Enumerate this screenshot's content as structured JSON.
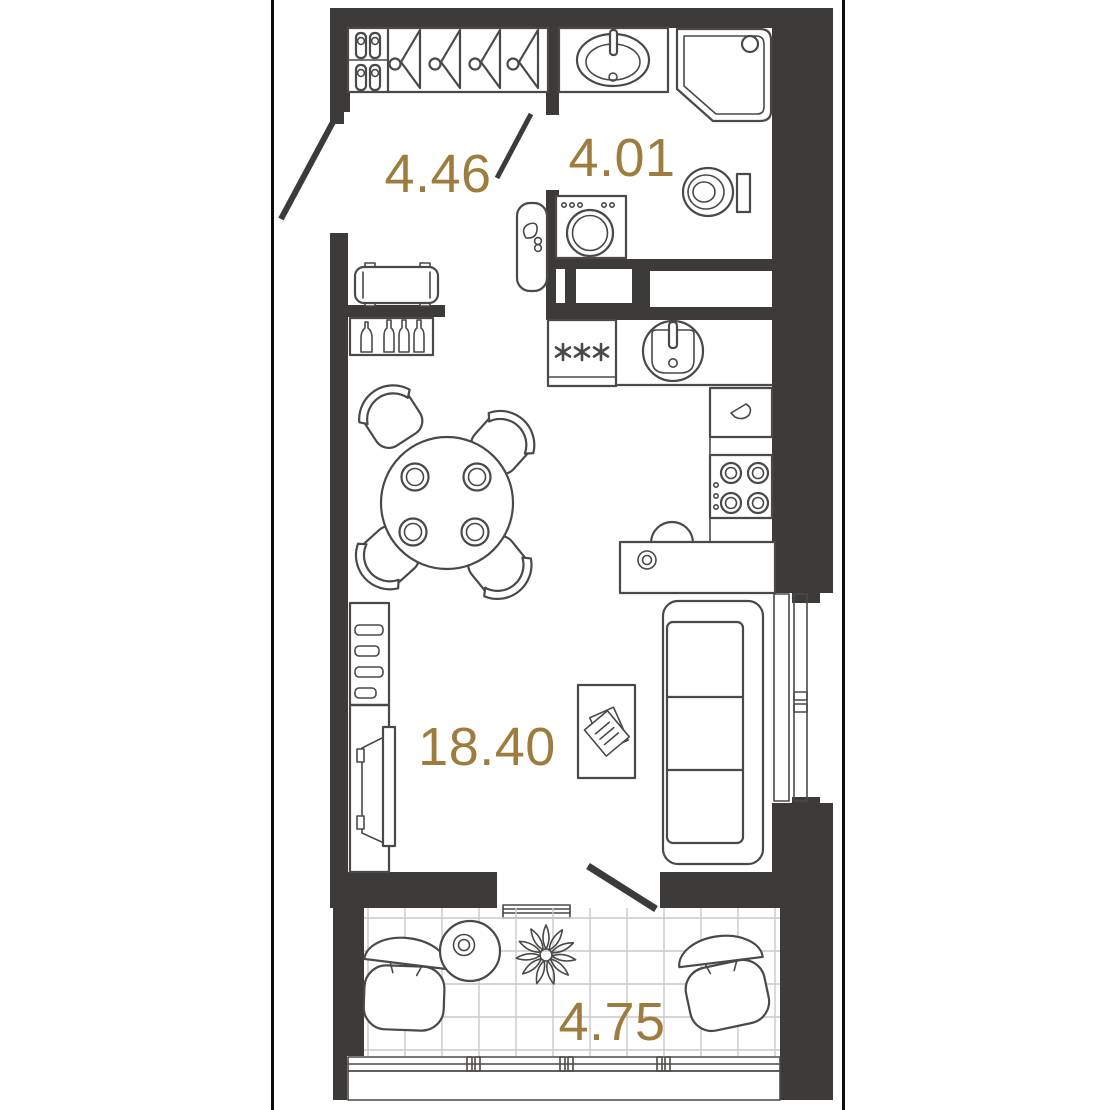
{
  "plan_type": "apartment-floor-plan",
  "colors": {
    "wall": "#3c3b39",
    "furniture_line": "#4a4947",
    "area_label": "#9d7c3d",
    "tile_grid": "#c9c9c9",
    "background": "#ffffff",
    "outer_border": "#0d0d0d"
  },
  "rooms": {
    "hallway": {
      "area": "4.46"
    },
    "bathroom": {
      "area": "4.01"
    },
    "living_kitchen": {
      "area": "18.40"
    },
    "balcony": {
      "area": "4.75"
    }
  },
  "furniture_icons": [
    "wardrobe-shoe-shelf-icon",
    "wardrobe-hangers-icon",
    "entrance-door-icon",
    "bathroom-sink-icon",
    "shower-cabin-icon",
    "toilet-icon",
    "washing-machine-icon",
    "water-heater-icon",
    "ventilation-shaft-icon",
    "fridge-icon",
    "kitchen-sink-icon",
    "kettle-icon",
    "stove-icon",
    "kitchen-desk-icon",
    "desk-chair-icon",
    "bench-icon",
    "bottle-shelf-icon",
    "dining-table-icon",
    "dining-chair-icon",
    "tv-console-icon",
    "tv-icon",
    "coffee-table-icon",
    "newspaper-icon",
    "sofa-icon",
    "window-icon",
    "balcony-door-icon",
    "armchair-icon",
    "side-table-icon",
    "plant-icon"
  ]
}
